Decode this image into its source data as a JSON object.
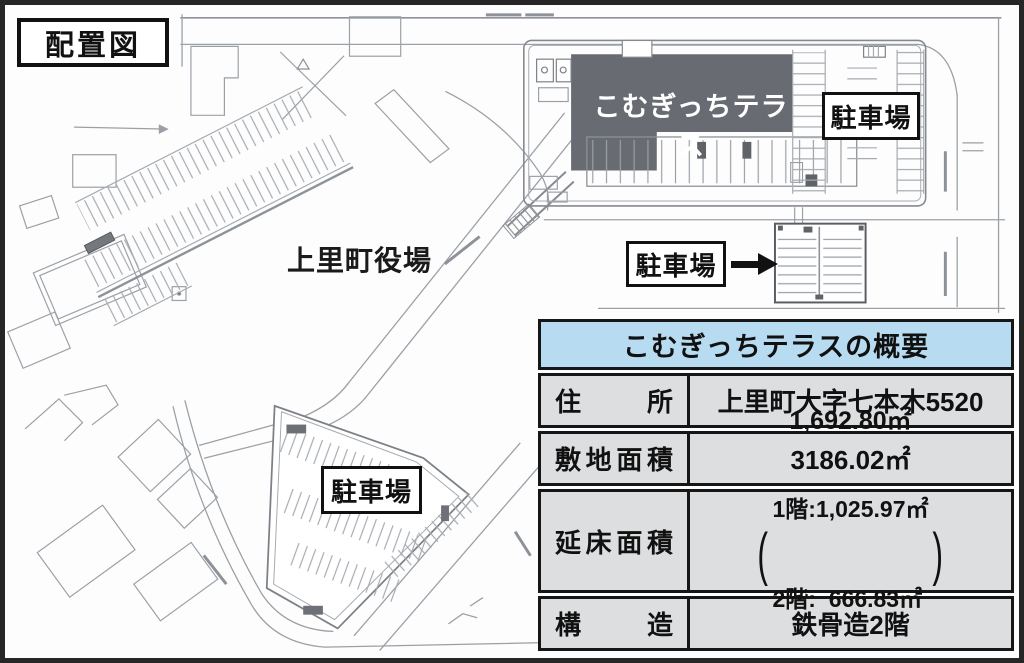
{
  "page": {
    "title_label": "配置図"
  },
  "map": {
    "facility_label": "こむぎっちテラス",
    "town_hall_label": "上里町役場",
    "parking_label_east": "駐車場",
    "parking_label_mid": "駐車場",
    "parking_label_south": "駐車場"
  },
  "table": {
    "title": "こむぎっちテラスの概要",
    "row_address": {
      "label": "住　所",
      "value": "上里町大字七本木5520"
    },
    "row_site_area": {
      "label": "敷地面積",
      "value": "3186.02㎡"
    },
    "row_floor_area": {
      "label": "延床面積",
      "total": "1,692.80㎡",
      "floor1": "1階:1,025.97㎡",
      "floor2": "2階:  666.83㎡",
      "paren_open": "(",
      "paren_close": ")"
    },
    "row_structure": {
      "label": "構　造",
      "value": "鉄骨造2階"
    }
  },
  "colors": {
    "accent_blue": "#b7dcf2",
    "cell_gray": "#dcdee0",
    "building_gray": "#686c72",
    "border_black": "#161616",
    "map_line_gray": "#a6abb1"
  }
}
